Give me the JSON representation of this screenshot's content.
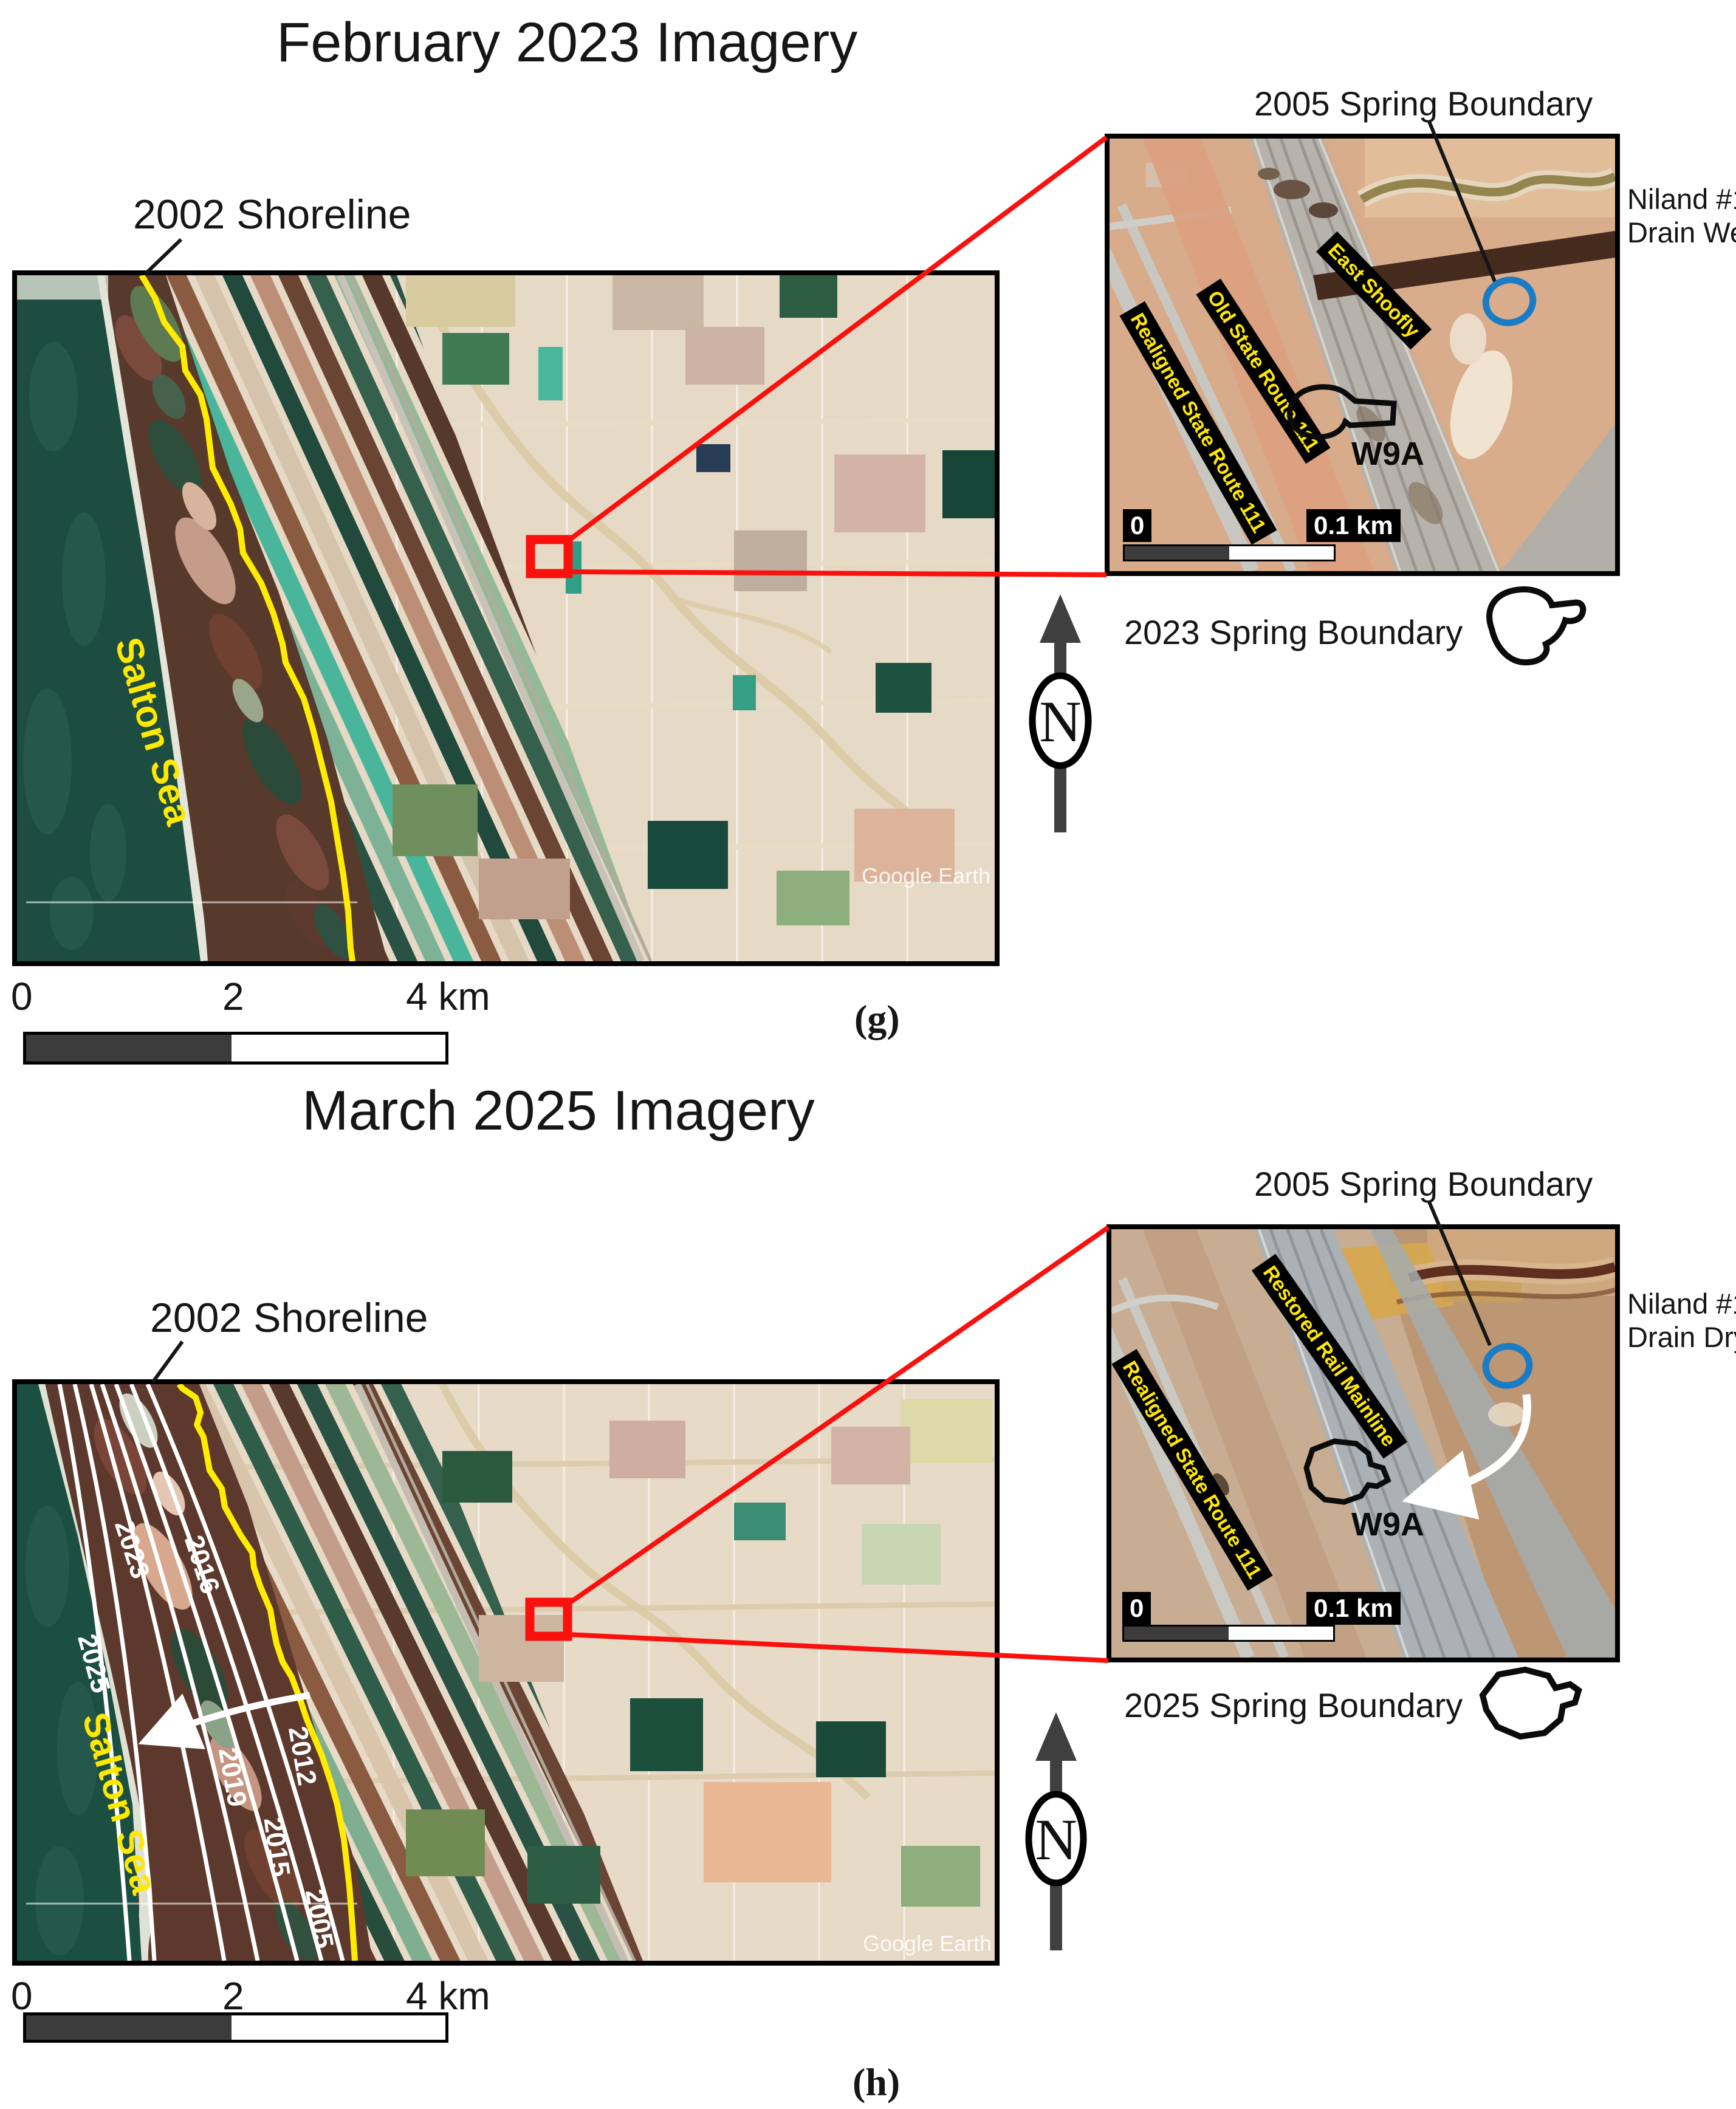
{
  "panels": {
    "g": {
      "title": "February 2023 Imagery",
      "tag": "(g)",
      "north_label": "N",
      "map": {
        "shoreline_label": "2002 Shoreline",
        "sea_label": "Salton Sea",
        "watermark": "Google Earth",
        "scale_ticks": [
          "0",
          "2",
          "4 km"
        ]
      },
      "inset": {
        "title": "2005 Spring Boundary",
        "drain_line1": "Niland #1",
        "drain_line2": "Drain Wet",
        "roads": [
          "East Shoofly",
          "Old State Route 111",
          "Realigned State Route 111"
        ],
        "spring_label": "W9A",
        "scale_zero": "0",
        "scale_label": "0.1 km",
        "legend_label": "2023 Spring Boundary"
      }
    },
    "h": {
      "title": "March 2025 Imagery",
      "tag": "(h)",
      "north_label": "N",
      "map": {
        "shoreline_label": "2002 Shoreline",
        "sea_label": "Salton Sea",
        "watermark": "Google Earth",
        "scale_ticks": [
          "0",
          "2",
          "4 km"
        ],
        "contour_labels": [
          "2023",
          "2016",
          "2025",
          "2012",
          "2019",
          "2015",
          "2005"
        ]
      },
      "inset": {
        "title": "2005 Spring Boundary",
        "drain_line1": "Niland #1",
        "drain_line2": "Drain Dry",
        "roads": [
          "Restored Rail Mainline",
          "Realigned State Route 111"
        ],
        "spring_label": "W9A",
        "scale_zero": "0",
        "scale_label": "0.1 km",
        "legend_label": "2025 Spring Boundary"
      }
    }
  },
  "colors": {
    "shoreline_yellow": "#ffec00",
    "highlight_red": "#fa100c",
    "spring_boundary_blue": "#1a7cc4",
    "road_label_yellow": "#ffe800",
    "sea_green": "#1d4c40"
  }
}
